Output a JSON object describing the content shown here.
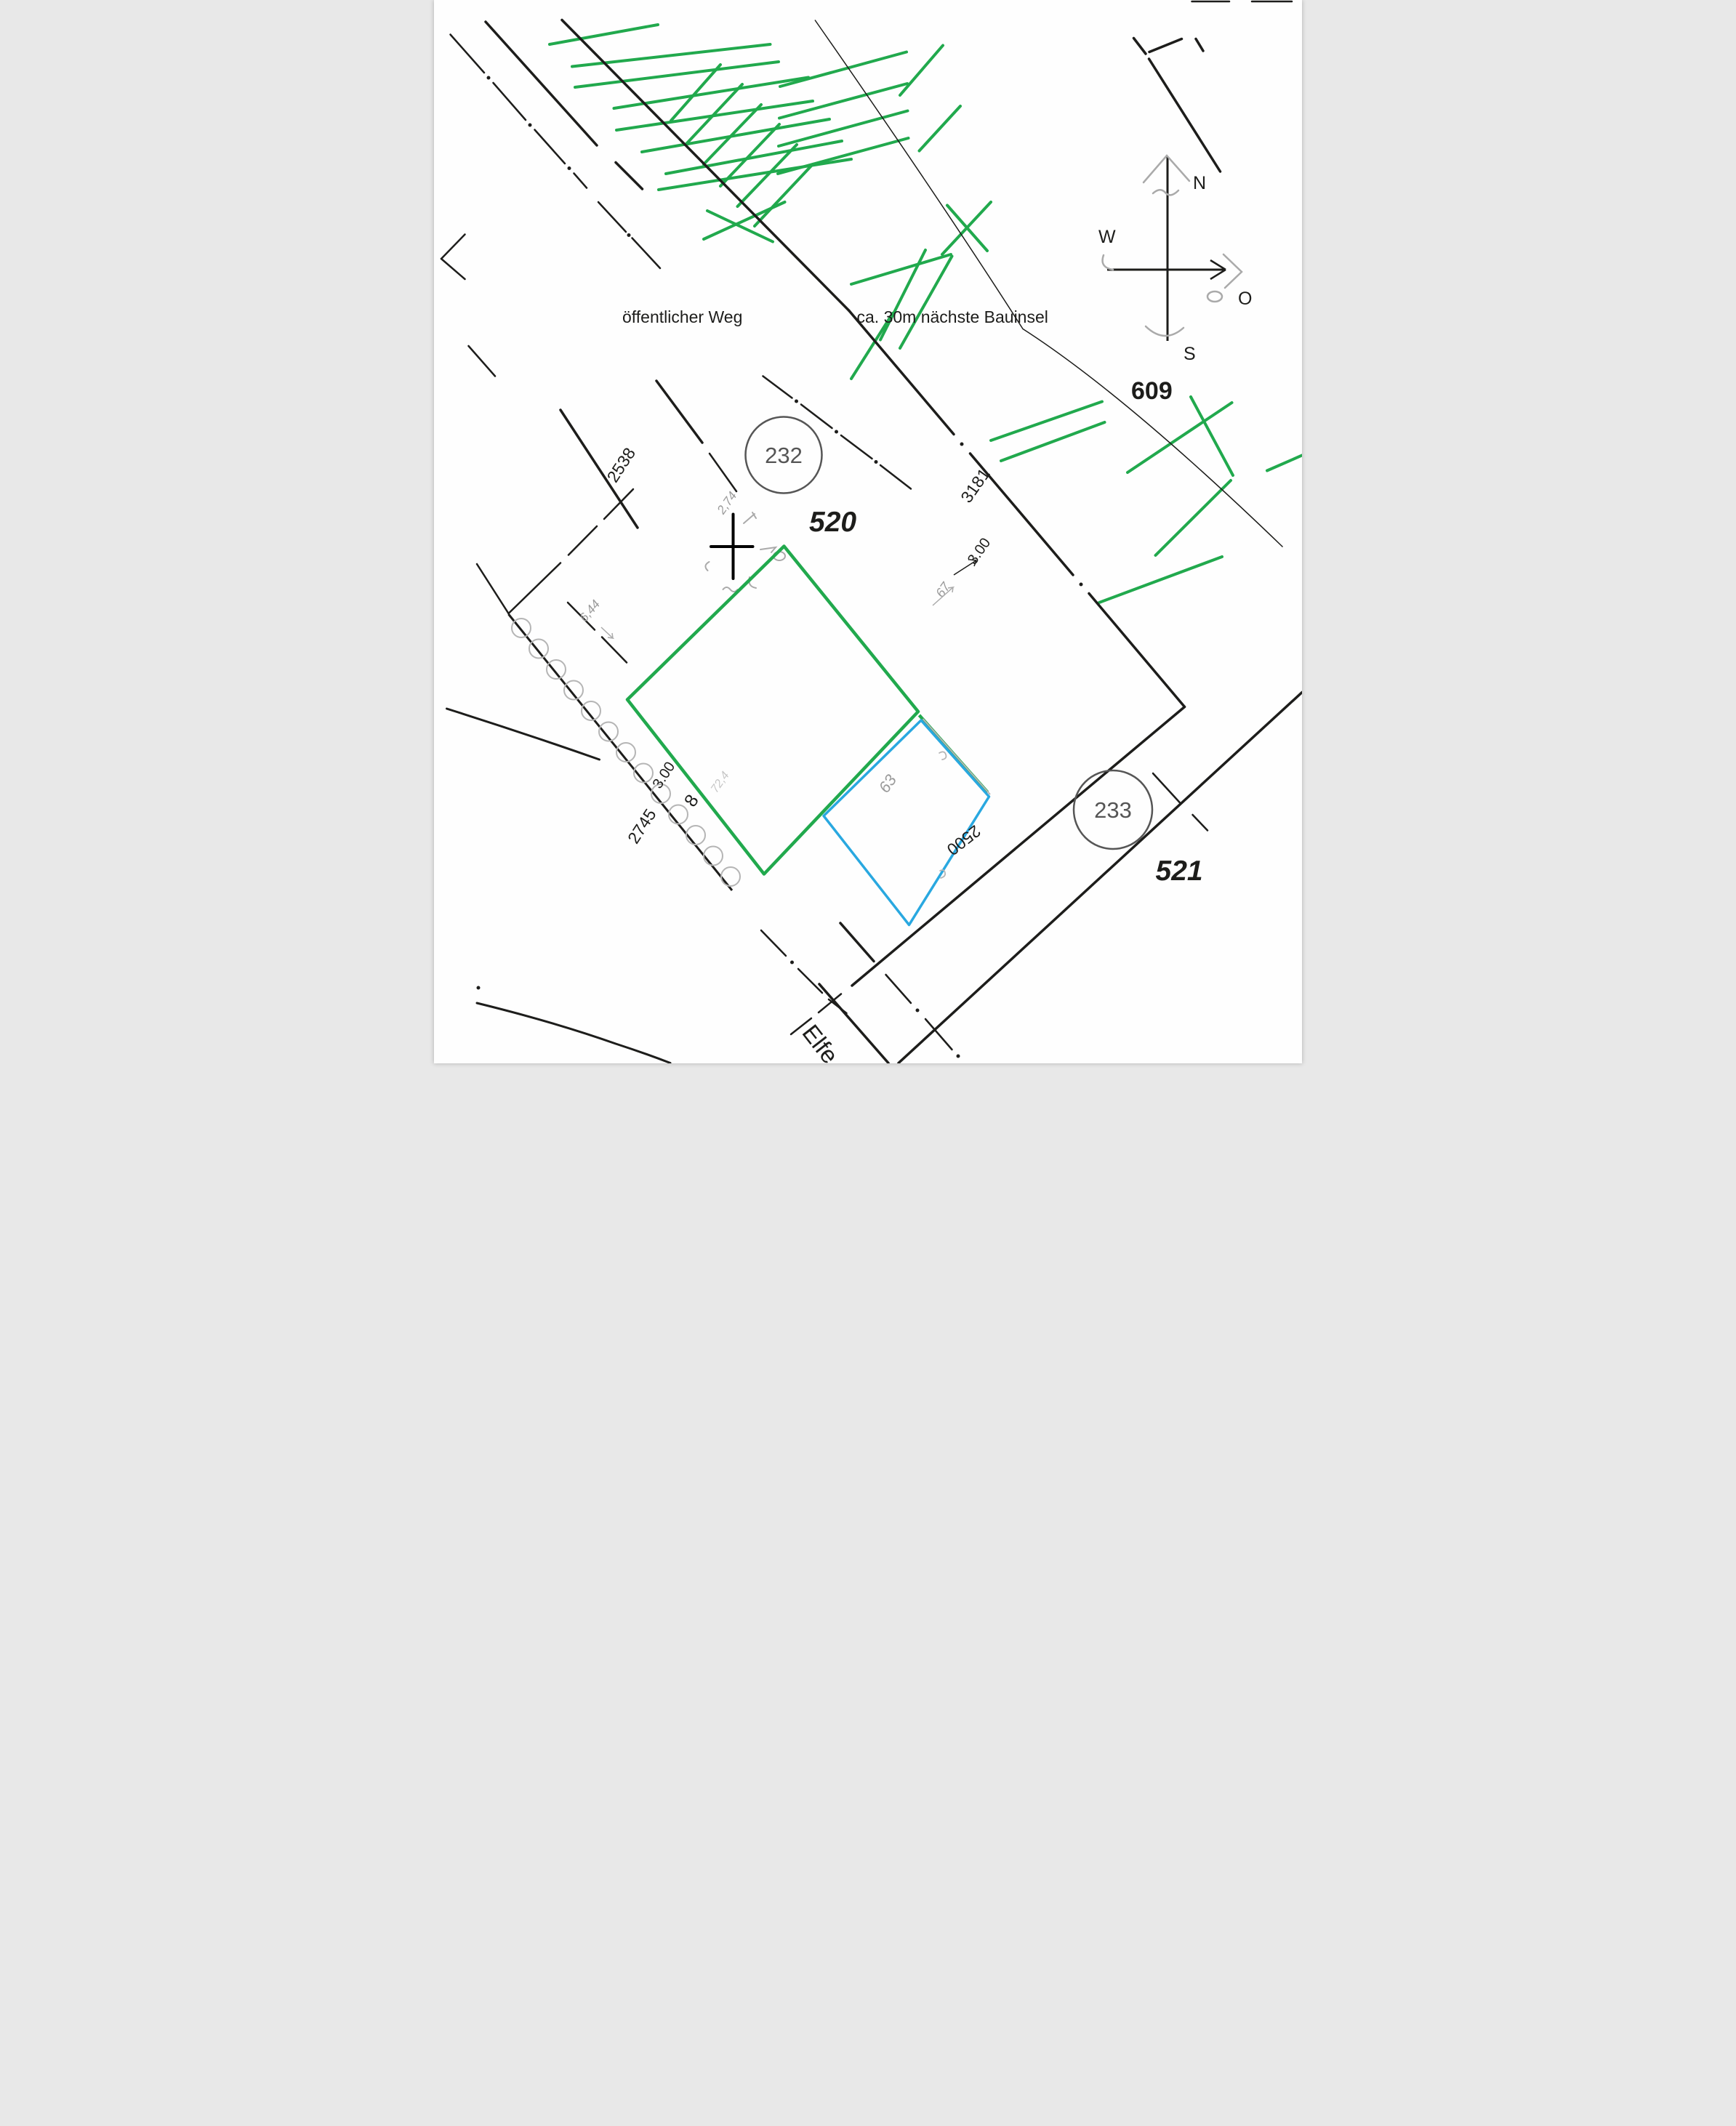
{
  "map": {
    "street_label": "öffentlicher Weg",
    "annotation": "ca. 30m nächste Bauinsel",
    "street_name_partial": "Elfe",
    "compass": {
      "north": "N",
      "west": "W",
      "east": "O",
      "south": "S"
    },
    "parcels": {
      "point_232": "232",
      "flur_520": "520",
      "point_233": "233",
      "flur_521": "521",
      "parcel_609": "609"
    },
    "measurements": {
      "nw_side": "2538",
      "ne_side": "3181",
      "ne_offset": "3.00",
      "sw_offset": "3.00",
      "sw_mark": "8",
      "sw_side": "2745",
      "se_side": "2500"
    },
    "handwritten": {
      "cross_note": "2,74",
      "west_note": "6,44",
      "ne_note": "67",
      "annex_note": "63",
      "faint_note": "72,4"
    },
    "colors": {
      "hatch_green": "#21a94d",
      "annex_blue": "#29a8e0",
      "pencil_gray": "#a8a8a8",
      "ink_black": "#1d1d1b"
    }
  },
  "geometry": {
    "hatch_lines": [
      [
        318,
        122,
        616,
        68
      ],
      [
        380,
        183,
        925,
        122
      ],
      [
        388,
        240,
        948,
        170
      ],
      [
        495,
        298,
        1030,
        213
      ],
      [
        502,
        358,
        1042,
        278
      ],
      [
        572,
        418,
        1088,
        328
      ],
      [
        638,
        478,
        1122,
        388
      ],
      [
        618,
        522,
        1148,
        438
      ],
      [
        652,
        332,
        788,
        178
      ],
      [
        695,
        395,
        848,
        232
      ],
      [
        742,
        452,
        900,
        288
      ],
      [
        788,
        512,
        950,
        342
      ],
      [
        835,
        568,
        998,
        398
      ],
      [
        882,
        622,
        1042,
        452
      ],
      [
        742,
        658,
        965,
        556
      ],
      [
        752,
        580,
        932,
        665
      ],
      [
        952,
        238,
        1300,
        143
      ],
      [
        950,
        325,
        1302,
        230
      ],
      [
        948,
        402,
        1303,
        305
      ],
      [
        946,
        478,
        1305,
        380
      ],
      [
        1282,
        262,
        1400,
        125
      ],
      [
        1335,
        415,
        1448,
        292
      ],
      [
        1148,
        782,
        1422,
        700
      ],
      [
        1228,
        935,
        1352,
        688
      ],
      [
        1282,
        958,
        1425,
        705
      ],
      [
        1148,
        1042,
        1262,
        862
      ],
      [
        1398,
        700,
        1532,
        556
      ],
      [
        1412,
        565,
        1522,
        690
      ],
      [
        1532,
        1212,
        1838,
        1105
      ],
      [
        1560,
        1268,
        1845,
        1162
      ],
      [
        1908,
        1300,
        2195,
        1108
      ],
      [
        2082,
        1092,
        2198,
        1308
      ],
      [
        2292,
        1295,
        2388,
        1253
      ],
      [
        1985,
        1528,
        2192,
        1322
      ],
      [
        1830,
        1658,
        2168,
        1532
      ]
    ],
    "solid_thick": [
      [
        142,
        60,
        448,
        400
      ],
      [
        500,
        447,
        573,
        520
      ],
      [
        352,
        55,
        1142,
        855
      ],
      [
        2065,
        1945,
        1150,
        2712
      ],
      [
        2388,
        1905,
        1278,
        2925
      ],
      [
        1118,
        2540,
        1210,
        2645
      ],
      [
        1060,
        2708,
        1250,
        2925
      ],
      [
        348,
        1128,
        560,
        1452
      ],
      [
        612,
        1048,
        738,
        1218
      ],
      [
        1925,
        105,
        1958,
        148
      ],
      [
        1968,
        143,
        2057,
        107
      ],
      [
        2096,
        107,
        2116,
        140
      ],
      [
        1967,
        162,
        2163,
        472
      ]
    ],
    "boundary_dashes": [
      [
        1142,
        855,
        1430,
        1195
      ],
      [
        1475,
        1248,
        1758,
        1582
      ],
      [
        1802,
        1633,
        2065,
        1945
      ]
    ],
    "dash_segments": [
      [
        45,
        95,
        138,
        200
      ],
      [
        163,
        228,
        252,
        330
      ],
      [
        277,
        357,
        360,
        450
      ],
      [
        385,
        477,
        420,
        517
      ],
      [
        452,
        556,
        528,
        638
      ],
      [
        545,
        655,
        622,
        738
      ],
      [
        85,
        645,
        20,
        712
      ],
      [
        20,
        712,
        85,
        768
      ],
      [
        95,
        952,
        168,
        1035
      ],
      [
        905,
        1035,
        985,
        1095
      ],
      [
        1010,
        1113,
        1095,
        1178
      ],
      [
        1120,
        1198,
        1205,
        1262
      ],
      [
        1228,
        1280,
        1312,
        1345
      ],
      [
        118,
        1552,
        205,
        1688
      ],
      [
        205,
        1688,
        348,
        1549
      ],
      [
        370,
        1527,
        448,
        1448
      ],
      [
        468,
        1428,
        548,
        1346
      ],
      [
        368,
        1658,
        442,
        1733
      ],
      [
        462,
        1753,
        530,
        1823
      ],
      [
        758,
        1248,
        832,
        1352
      ],
      [
        1978,
        2128,
        2055,
        2212
      ],
      [
        2087,
        2242,
        2128,
        2285
      ],
      [
        900,
        2560,
        968,
        2630
      ],
      [
        1002,
        2666,
        1068,
        2732
      ],
      [
        1086,
        2750,
        1135,
        2788
      ],
      [
        1243,
        2682,
        1312,
        2760
      ],
      [
        1352,
        2804,
        1425,
        2888
      ],
      [
        1120,
        2735,
        1058,
        2786
      ],
      [
        1038,
        2802,
        982,
        2846
      ],
      [
        2085,
        4,
        2188,
        4
      ],
      [
        2250,
        4,
        2360,
        4
      ]
    ],
    "dots": [
      [
        150,
        214
      ],
      [
        264,
        344
      ],
      [
        372,
        463
      ],
      [
        536,
        647
      ],
      [
        997,
        1104
      ],
      [
        1107,
        1188
      ],
      [
        1216,
        1271
      ],
      [
        1452,
        1222
      ],
      [
        1780,
        1608
      ],
      [
        985,
        2648
      ],
      [
        1330,
        2780
      ],
      [
        1442,
        2906
      ],
      [
        122,
        2718
      ]
    ],
    "fence_circles": [
      [
        240,
        1728
      ],
      [
        288,
        1785
      ],
      [
        336,
        1842
      ],
      [
        384,
        1899
      ],
      [
        432,
        1956
      ],
      [
        480,
        2013
      ],
      [
        528,
        2070
      ],
      [
        576,
        2127
      ],
      [
        624,
        2184
      ],
      [
        672,
        2241
      ],
      [
        720,
        2298
      ],
      [
        768,
        2355
      ],
      [
        816,
        2412
      ]
    ]
  }
}
